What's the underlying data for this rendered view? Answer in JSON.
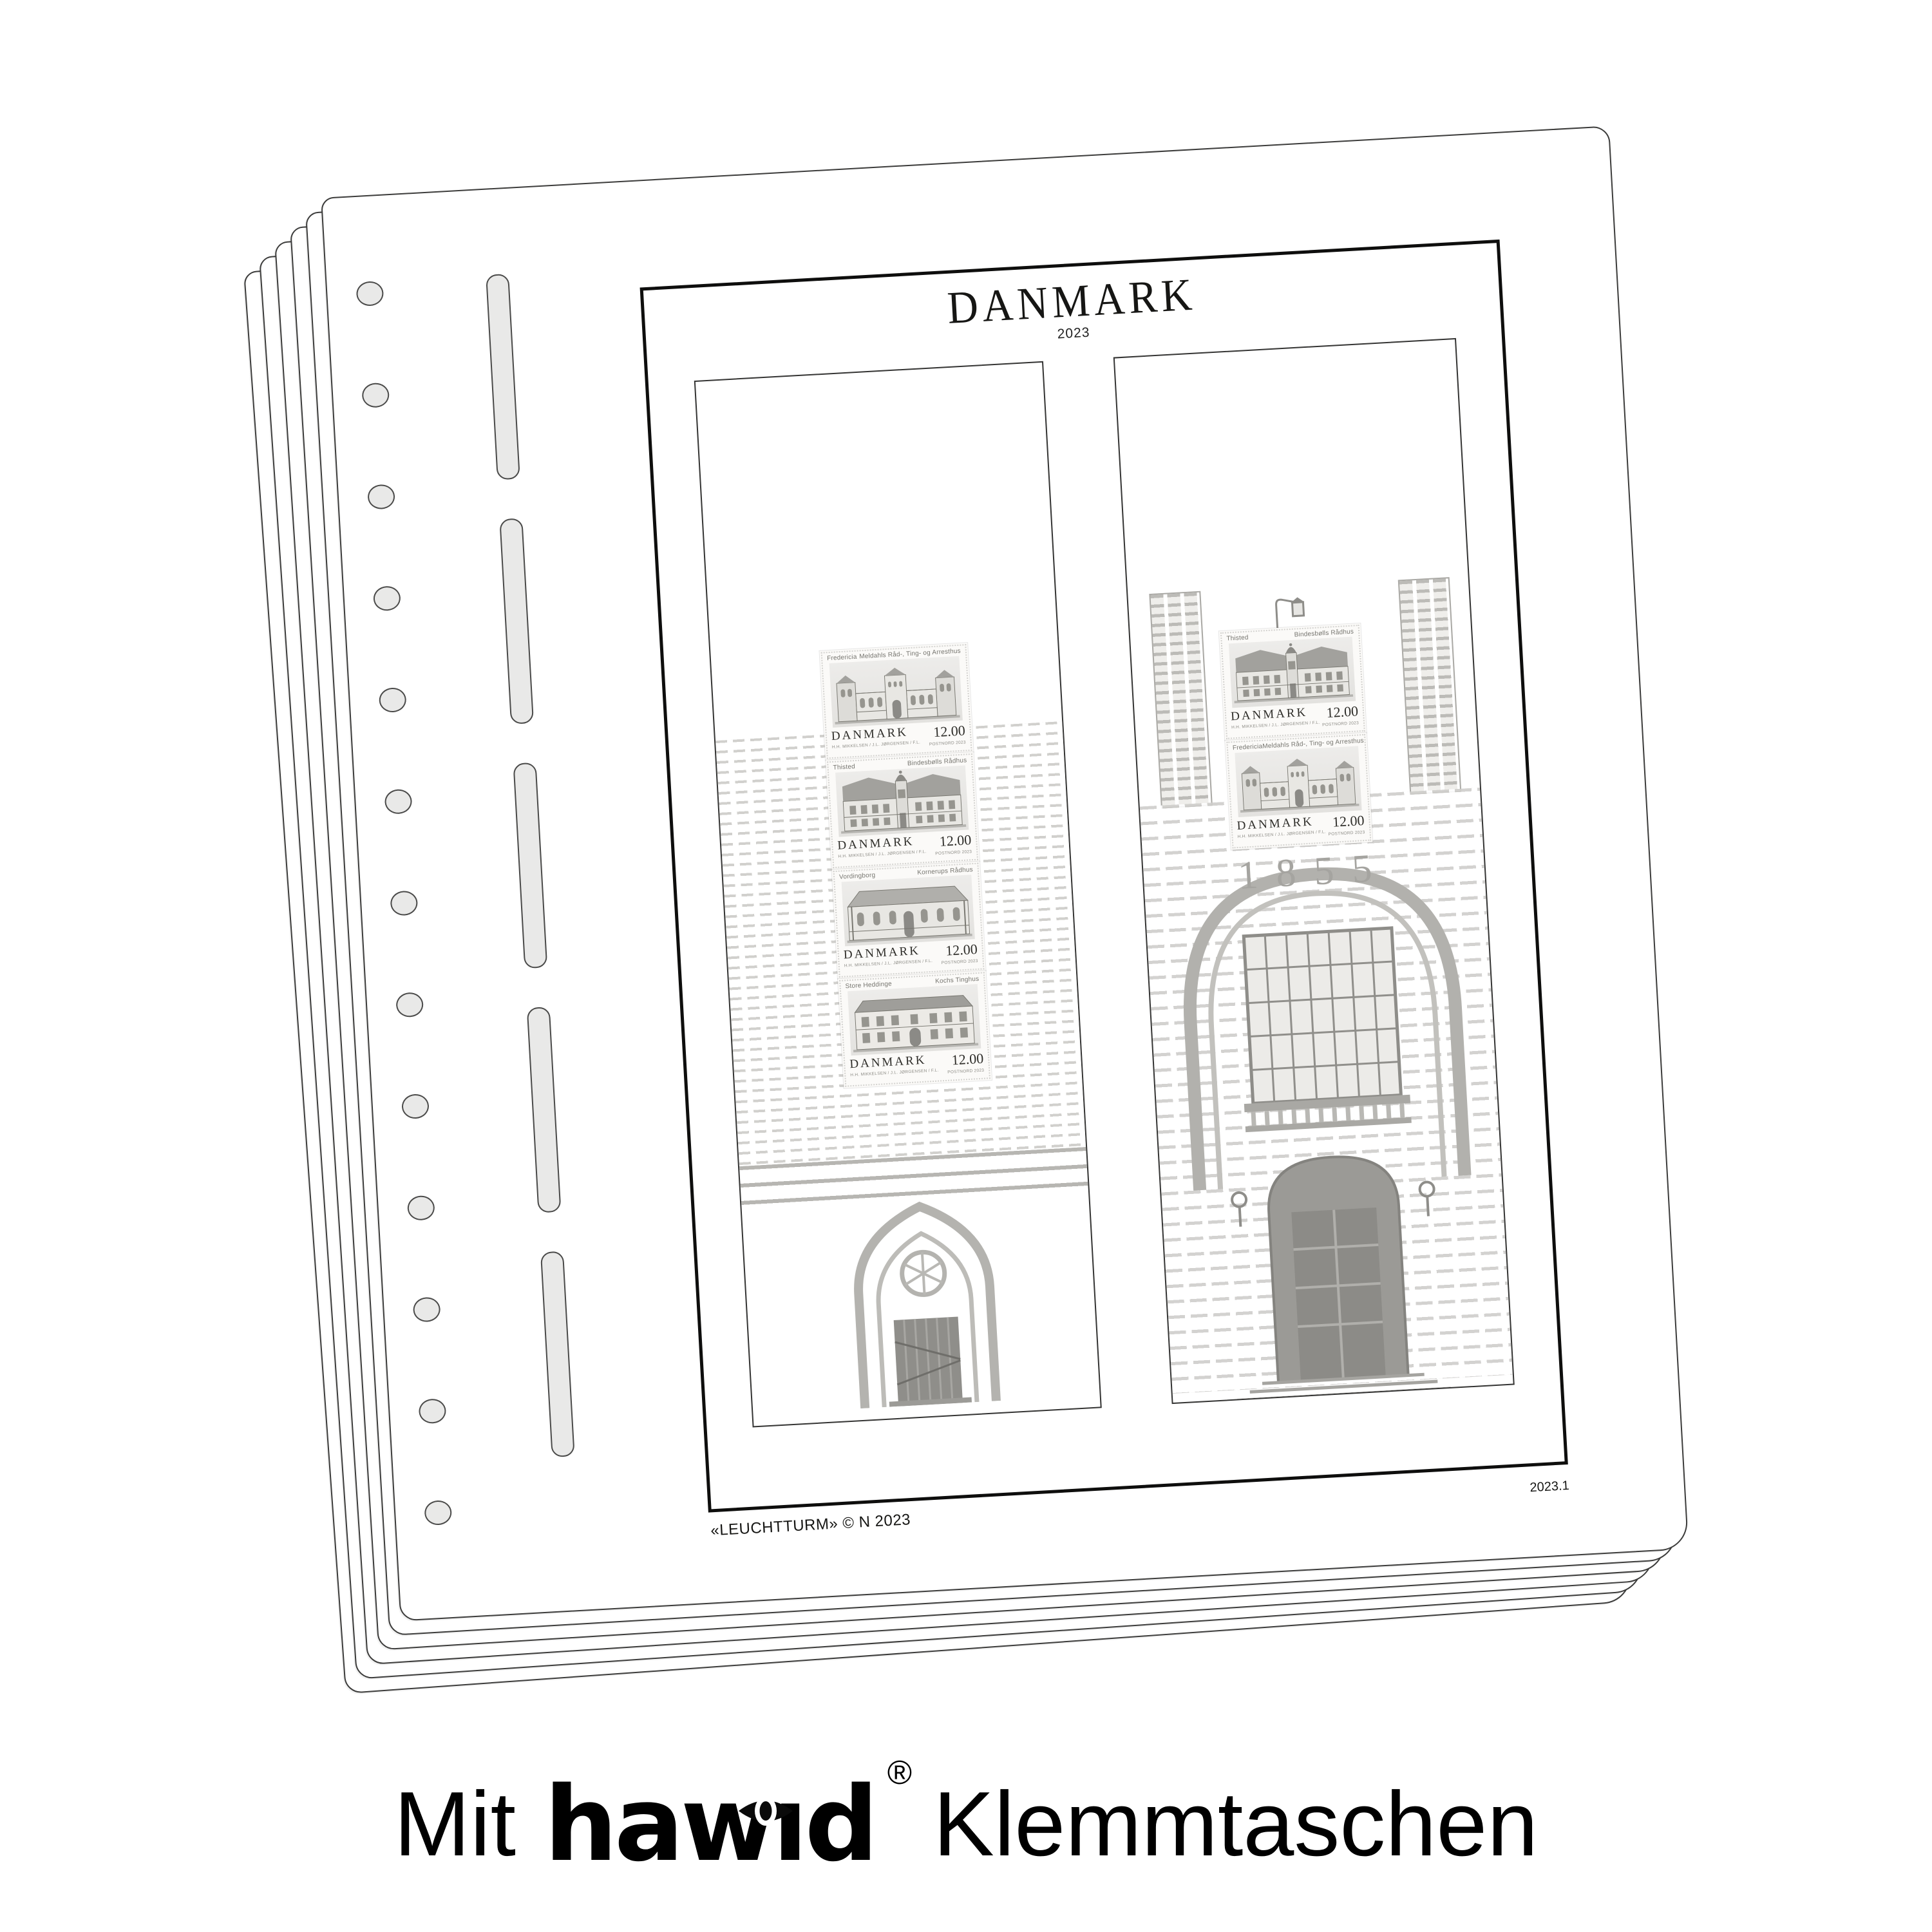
{
  "product": {
    "caption": {
      "prefix": "Mit",
      "brand": "hawid",
      "registered": "®",
      "suffix": "Klemmtaschen"
    }
  },
  "album_page": {
    "country_title": "DANMARK",
    "year_subtitle": "2023",
    "footer_left": "«LEUCHTTURM» © N 2023",
    "page_number": "2023.1",
    "sheet_count": 6,
    "binder": {
      "hole_count": 13,
      "slot_count": 5
    },
    "background_inscription": "1855",
    "columns": {
      "left": {
        "stamps": [
          {
            "city": "Fredericia",
            "building": "Meldahls Råd-, Ting- og Arresthus",
            "country": "DANMARK",
            "value": "12.00",
            "credits": "H.H. MIKKELSEN / J.L. JØRGENSEN / F.L.",
            "issue": "POSTNORD 2023",
            "art": "townhall-fredericia"
          },
          {
            "city": "Thisted",
            "building": "Bindesbølls Rådhus",
            "country": "DANMARK",
            "value": "12.00",
            "credits": "H.H. MIKKELSEN / J.L. JØRGENSEN / F.L.",
            "issue": "POSTNORD 2023",
            "art": "townhall-thisted"
          },
          {
            "city": "Vordingborg",
            "building": "Kornerups Rådhus",
            "country": "DANMARK",
            "value": "12.00",
            "credits": "H.H. MIKKELSEN / J.L. JØRGENSEN / F.L.",
            "issue": "POSTNORD 2023",
            "art": "townhall-vordingborg"
          },
          {
            "city": "Store Heddinge",
            "building": "Kochs Tinghus",
            "country": "DANMARK",
            "value": "12.00",
            "credits": "H.H. MIKKELSEN / J.L. JØRGENSEN / F.L.",
            "issue": "POSTNORD 2023",
            "art": "townhall-kochs"
          }
        ]
      },
      "right": {
        "ornament": "street-lamp-icon",
        "stamps": [
          {
            "city": "Thisted",
            "building": "Bindesbølls Rådhus",
            "country": "DANMARK",
            "value": "12.00",
            "credits": "H.H. MIKKELSEN / J.L. JØRGENSEN / F.L.",
            "issue": "POSTNORD 2023",
            "art": "townhall-thisted"
          },
          {
            "city": "Fredericia",
            "building": "Meldahls Råd-, Ting- og Arresthus",
            "country": "DANMARK",
            "value": "12.00",
            "credits": "H.H. MIKKELSEN / J.L. JØRGENSEN / F.L.",
            "issue": "POSTNORD 2023",
            "art": "townhall-fredericia"
          }
        ]
      }
    }
  },
  "colors": {
    "paper": "#ffffff",
    "sheet_edge": "#3c3c3b",
    "frame": "#0e0e0d",
    "hole_fill": "#e9e9e8",
    "etching": "#b4b3af",
    "stamp_paper": "#fbfaf8",
    "caption_text": "#000000"
  }
}
